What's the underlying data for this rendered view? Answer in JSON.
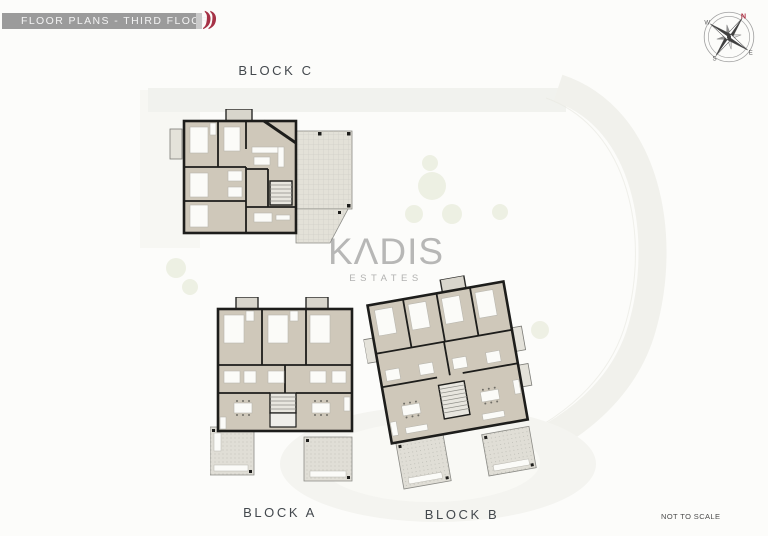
{
  "header": {
    "title": "FLOOR PLANS - THIRD FLOOR",
    "accent_marks": "))"
  },
  "compass": {
    "north": "N",
    "east": "E",
    "south": "S",
    "west": "W"
  },
  "watermark": {
    "brand": "KΛDIS",
    "subtitle": "ESTATES"
  },
  "blocks": [
    {
      "id": "c",
      "label": "BLOCK C"
    },
    {
      "id": "a",
      "label": "BLOCK A"
    },
    {
      "id": "b",
      "label": "BLOCK B"
    }
  ],
  "footer": {
    "scale_note": "NOT TO SCALE"
  },
  "colors": {
    "header_bar": "#9b9b9b",
    "accent_red": "#a63246",
    "label_text": "#43484d",
    "floor_fill": "#cfc8ba",
    "wall": "#1d1d1b",
    "terrace_fill": "#e2e0d8",
    "watermark_gray": "#8c8c8c"
  }
}
